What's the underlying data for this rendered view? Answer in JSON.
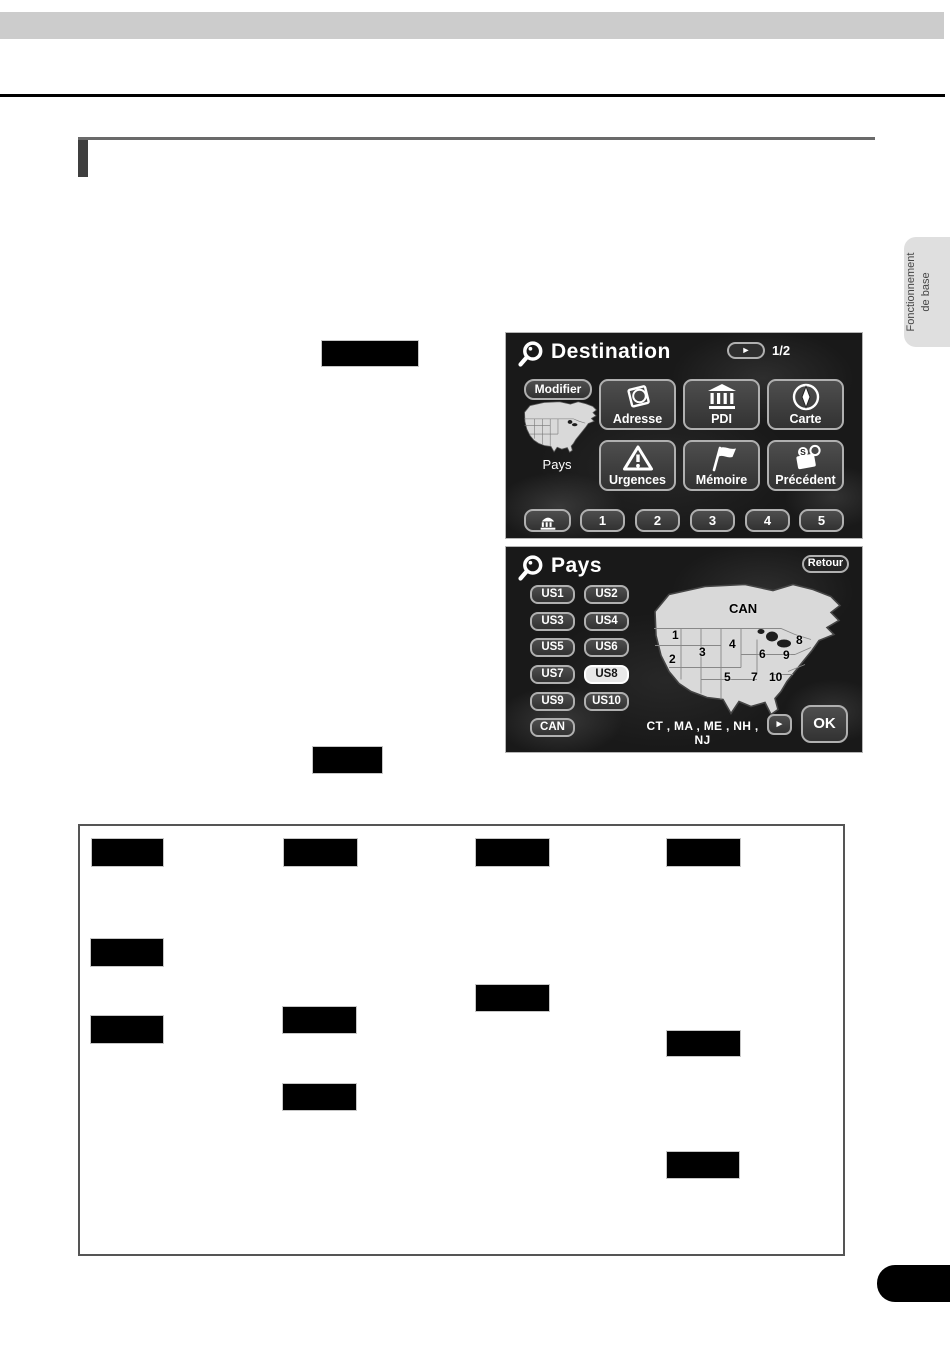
{
  "side_tab": {
    "line1": "Fonctionnement",
    "line2": "de base"
  },
  "destination_screen": {
    "title": "Destination",
    "page_indicator": "1/2",
    "next_arrow": "►",
    "modifier_button": "Modifier",
    "map_label": "Pays",
    "menu_buttons": [
      {
        "label": "Adresse"
      },
      {
        "label": "PDI"
      },
      {
        "label": "Carte"
      },
      {
        "label": "Urgences"
      },
      {
        "label": "Mémoire"
      },
      {
        "label": "Précédent"
      }
    ],
    "preset_buttons": [
      "1",
      "2",
      "3",
      "4",
      "5"
    ]
  },
  "pays_screen": {
    "title": "Pays",
    "retour_button": "Retour",
    "zone_buttons": [
      {
        "label": "US1",
        "selected": false
      },
      {
        "label": "US2",
        "selected": false
      },
      {
        "label": "US3",
        "selected": false
      },
      {
        "label": "US4",
        "selected": false
      },
      {
        "label": "US5",
        "selected": false
      },
      {
        "label": "US6",
        "selected": false
      },
      {
        "label": "US7",
        "selected": false
      },
      {
        "label": "US8",
        "selected": true
      },
      {
        "label": "US9",
        "selected": false
      },
      {
        "label": "US10",
        "selected": false
      },
      {
        "label": "CAN",
        "selected": false
      }
    ],
    "map_labels": [
      "CAN",
      "1",
      "2",
      "3",
      "4",
      "5",
      "6",
      "7",
      "8",
      "9",
      "10"
    ],
    "states_list": "CT , MA , ME , NH , NJ",
    "scroll_arrow": "►",
    "ok_button": "OK"
  },
  "colors": {
    "screen_background": "#191919",
    "screen_button": "#3e3e3e",
    "screen_button_border": "#b0b0b0",
    "selected_zone_background": "#e8e8e8",
    "map_fill": "#d9d9d9",
    "top_bar": "#cccccc",
    "side_tab_background": "#dfdfdf",
    "redaction": "#000000"
  }
}
